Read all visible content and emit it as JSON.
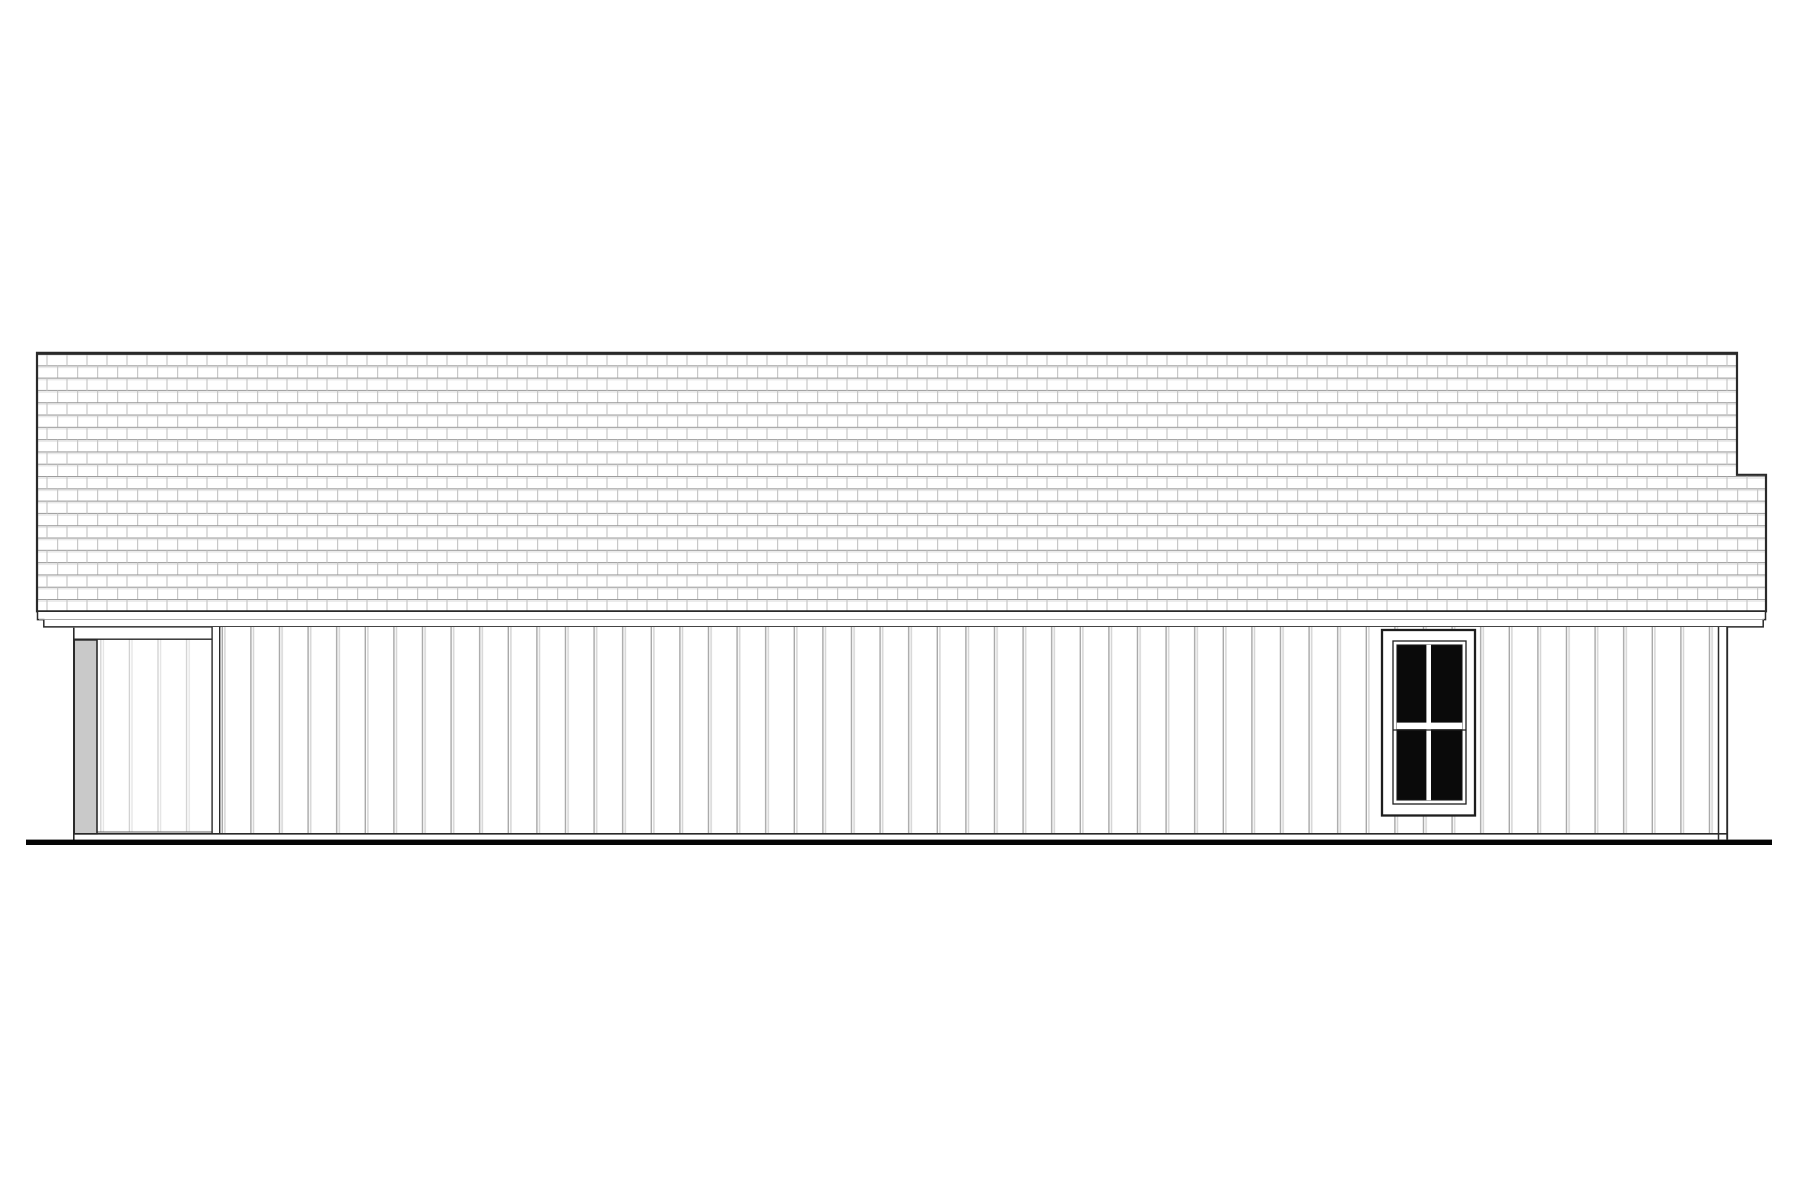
{
  "canvas": {
    "width": 1800,
    "height": 1200
  },
  "scene": {
    "description": "Black-and-white architectural side elevation drawing of a single-story house: long shingled roof with stepped right edge, fascia band, vertical board-and-batten siding, recessed porch bay with gray square post at far left, white corner boards, one dark four-pane double-hung window under the right eave, and a thick ground grade line."
  },
  "colors": {
    "background": "#ffffff",
    "paper_white": "#ffffff",
    "outline_dark": "#2a2a2a",
    "trim_dark": "#1d1d1d",
    "line_soft": "#9e9e9e",
    "base_line": "#5f5f5f",
    "shingle_course": "#9c9c9c",
    "shingle_shadow": "#e3e3e3",
    "shingle_joint": "#c8c8c8",
    "batten_dark": "#a7a7a7",
    "batten_light": "#d5d5d5",
    "porch_batten_dark": "#cdcdcd",
    "porch_batten_light": "#e4e4e4",
    "post_fill": "#c9c9c9",
    "glass_fill": "#0a0a0a",
    "ground_fill": "#050505"
  }
}
